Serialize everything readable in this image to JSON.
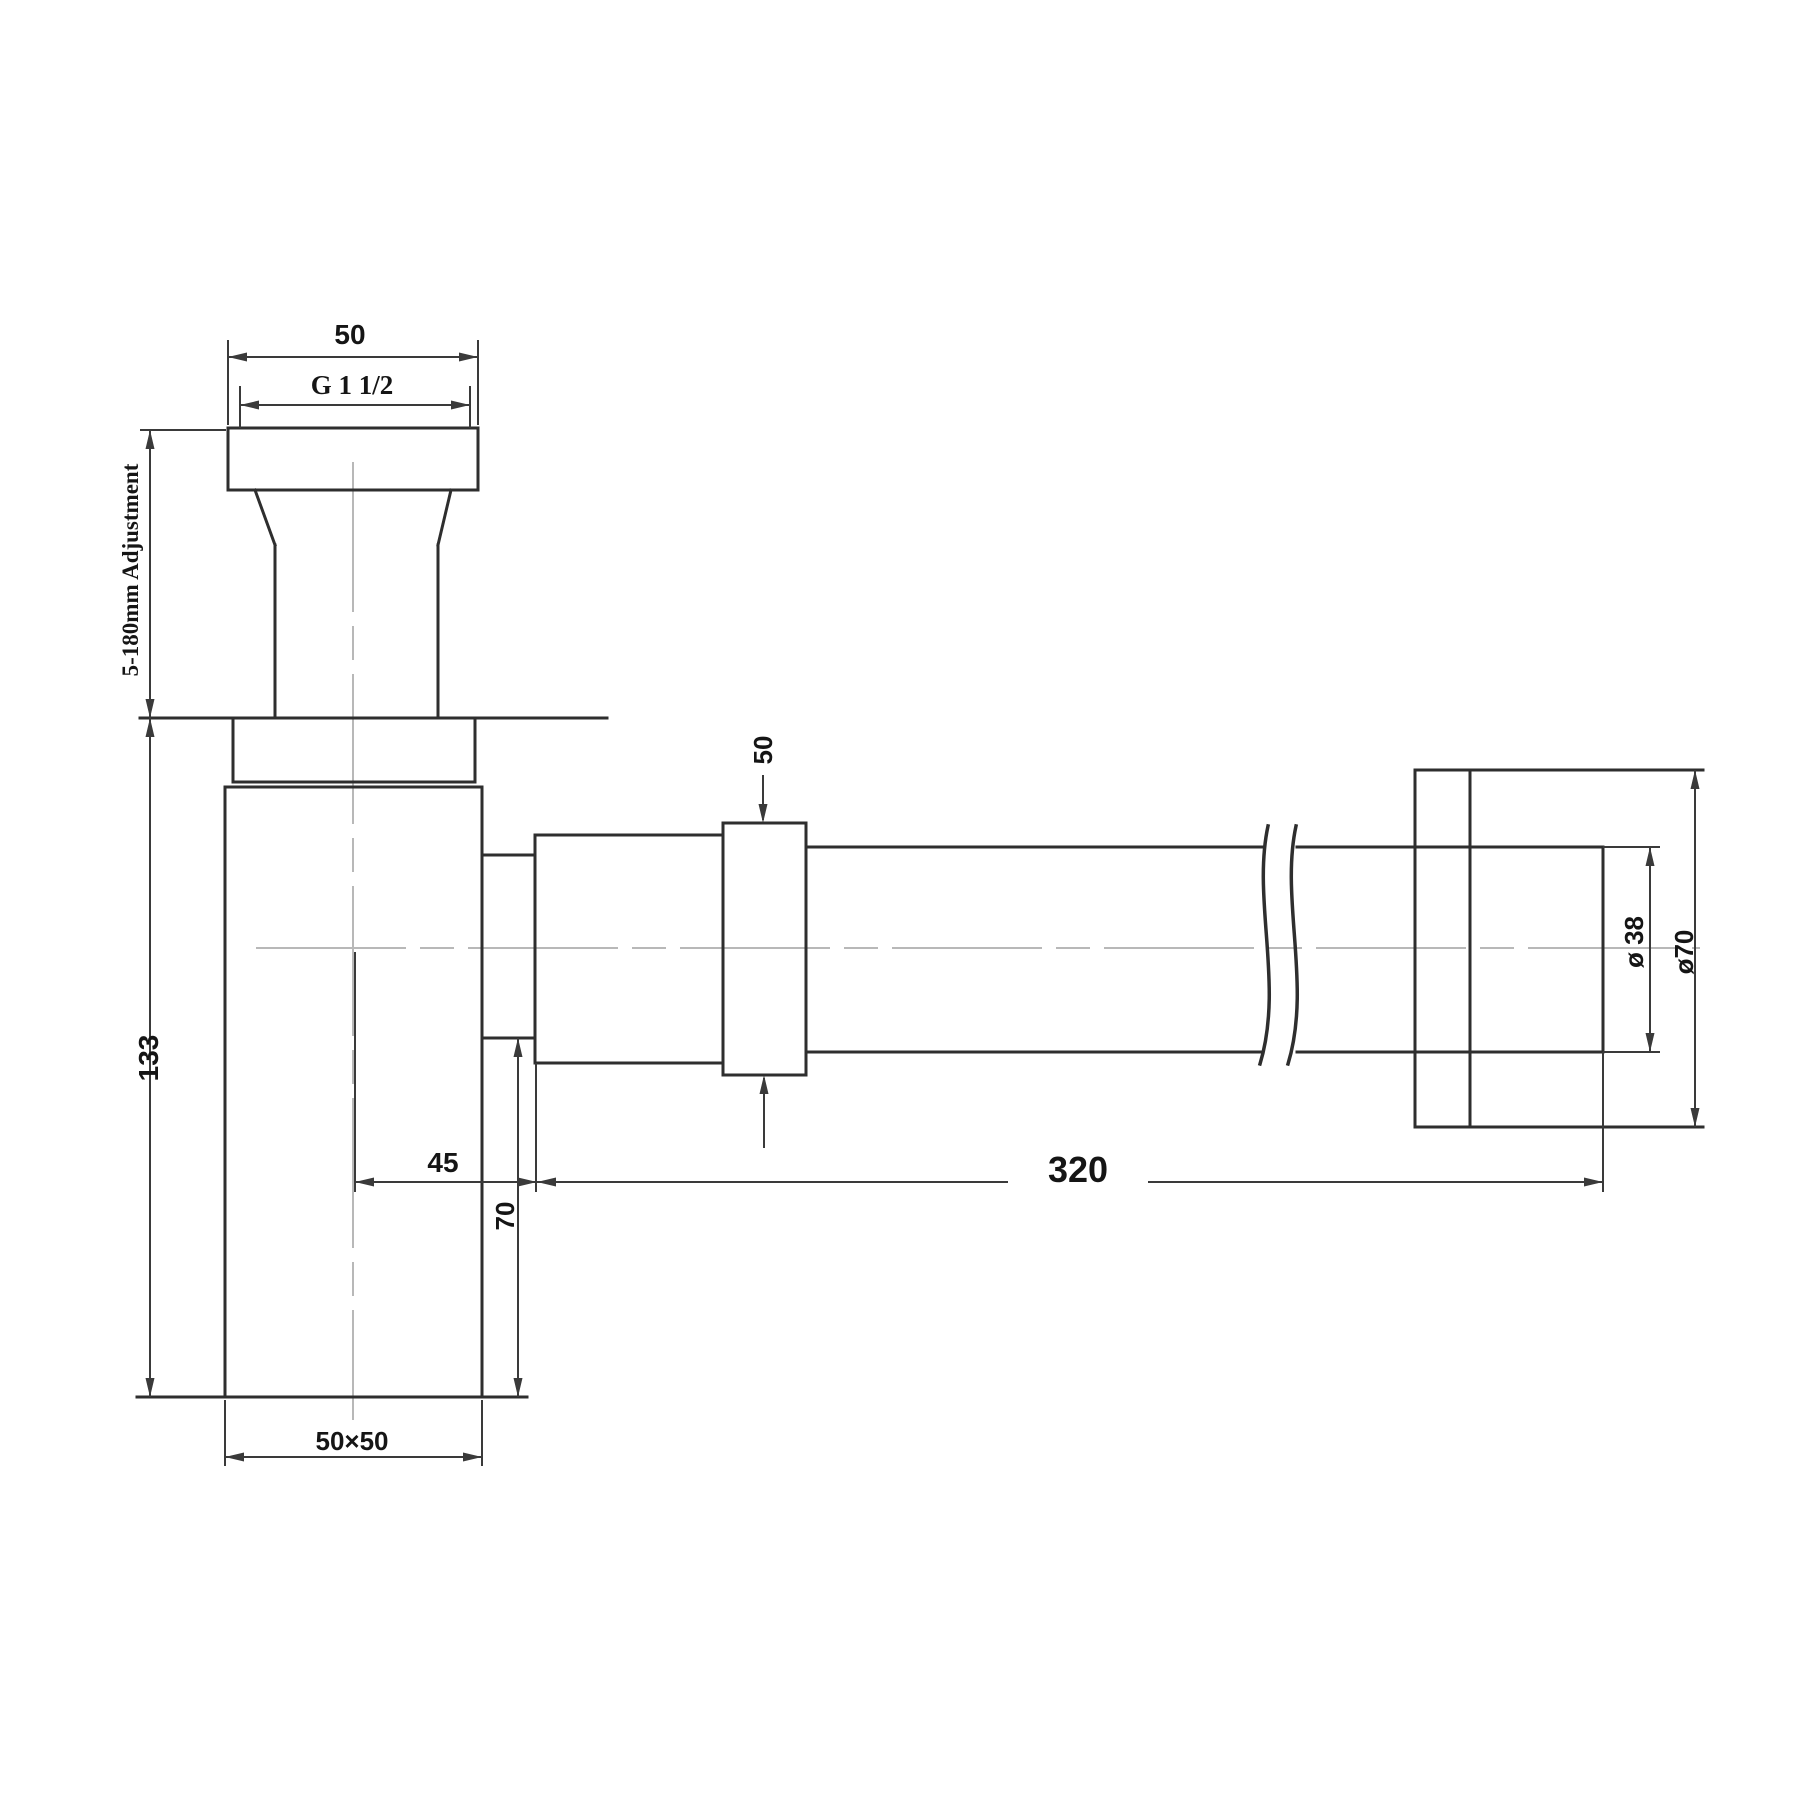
{
  "meta": {
    "type": "technical-drawing",
    "subject": "Bottle trap siphon with wall outlet tube - dimensioned side view",
    "background_color": "#ffffff",
    "line_color": "#2e2e2e",
    "centerline_color": "#b8b8b8"
  },
  "labels": {
    "tailpiece_width": "50",
    "thread_size": "G 1 1/2",
    "height_adjustment": "5-180mm Adjustment",
    "body_height": "133",
    "body_cross_section": "50×50",
    "outlet_offset": "45",
    "outlet_drop": "70",
    "collar_length": "50",
    "tube_length": "320",
    "tube_diameter": "ø 38",
    "flange_diameter": "ø70"
  }
}
